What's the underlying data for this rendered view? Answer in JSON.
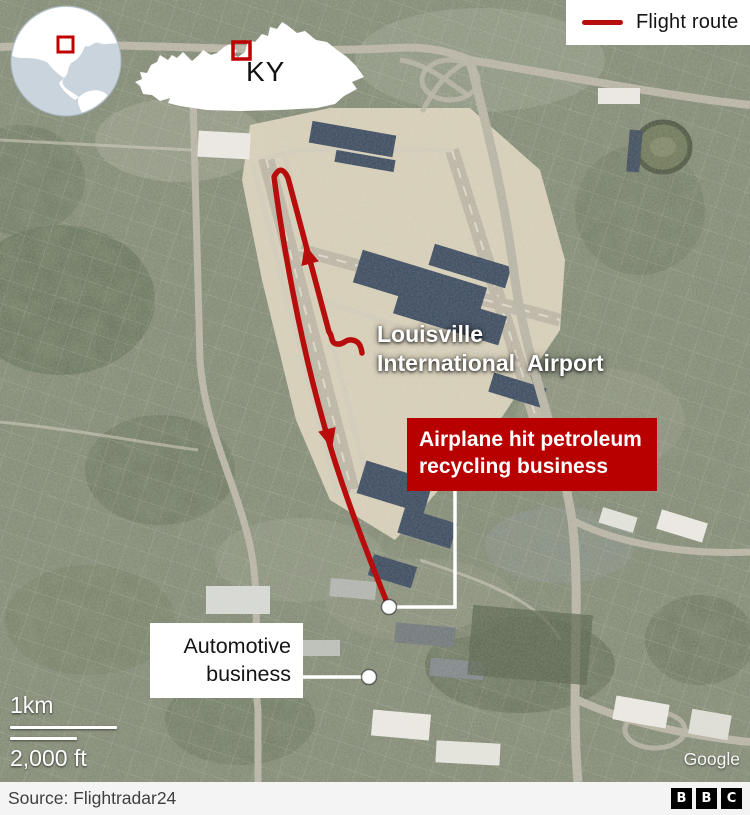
{
  "legend": {
    "label": "Flight route"
  },
  "inset": {
    "state_abbr": "KY"
  },
  "labels": {
    "airport_line1": "Louisville",
    "airport_line2": "International  Airport",
    "crash_callout": "Airplane hit petroleum recycling business",
    "automotive_line1": "Automotive",
    "automotive_line2": "business"
  },
  "scalebar": {
    "metric": "1km",
    "imperial": "2,000 ft"
  },
  "attribution": {
    "imagery": "Google"
  },
  "footer": {
    "source": "Source: Flightradar24",
    "logo": [
      "B",
      "B",
      "C"
    ]
  },
  "colors": {
    "flight_route": "#b80d0d",
    "callout_bg": "#b80000",
    "locator_square": "#c00000",
    "connector_white": "#ffffff"
  }
}
